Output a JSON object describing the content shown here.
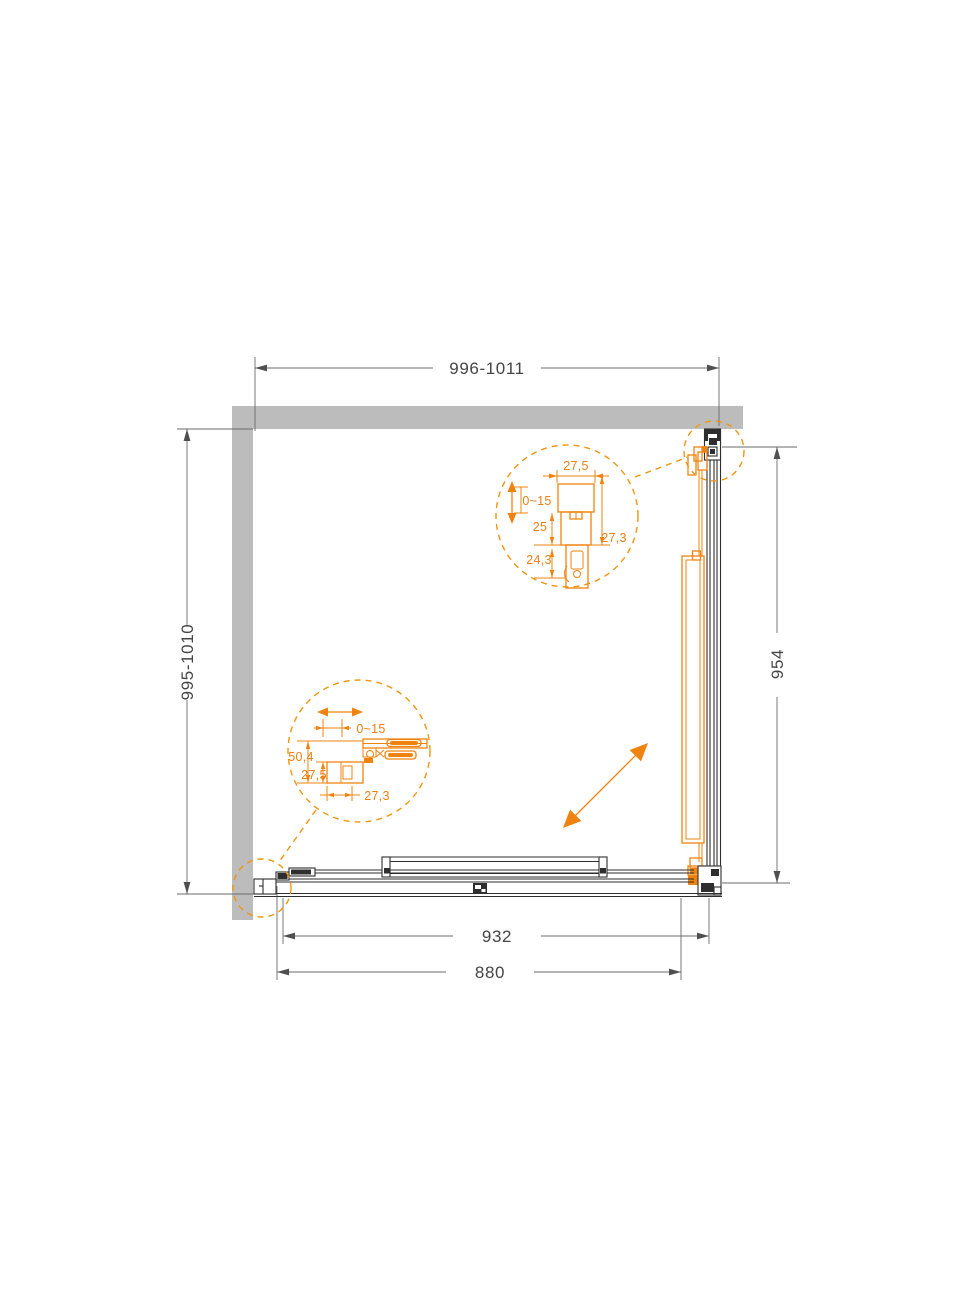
{
  "drawing": {
    "type": "shower-enclosure-plan-view",
    "colors": {
      "accent_orange": "#F0830F",
      "wall_gray": "#BCBCBC",
      "structure_line": "#2E2E2E",
      "dimension_line": "#6A6A6A",
      "dimension_text": "#454545"
    }
  },
  "dimensions": {
    "top_width": "996-1011",
    "left_height": "995-1010",
    "right_height": "954",
    "bottom_inner_width": "932",
    "bottom_door_width": "880"
  },
  "detail_top": {
    "profile_width": "27,5",
    "adjustment_range": "0~15",
    "dim_mid": "25",
    "dim_lower": "24,3",
    "profile_depth": "27,3"
  },
  "detail_bottom": {
    "adjustment_range": "0~15",
    "profile_height": "50,4",
    "profile_width": "27,5",
    "profile_depth": "27,3"
  }
}
